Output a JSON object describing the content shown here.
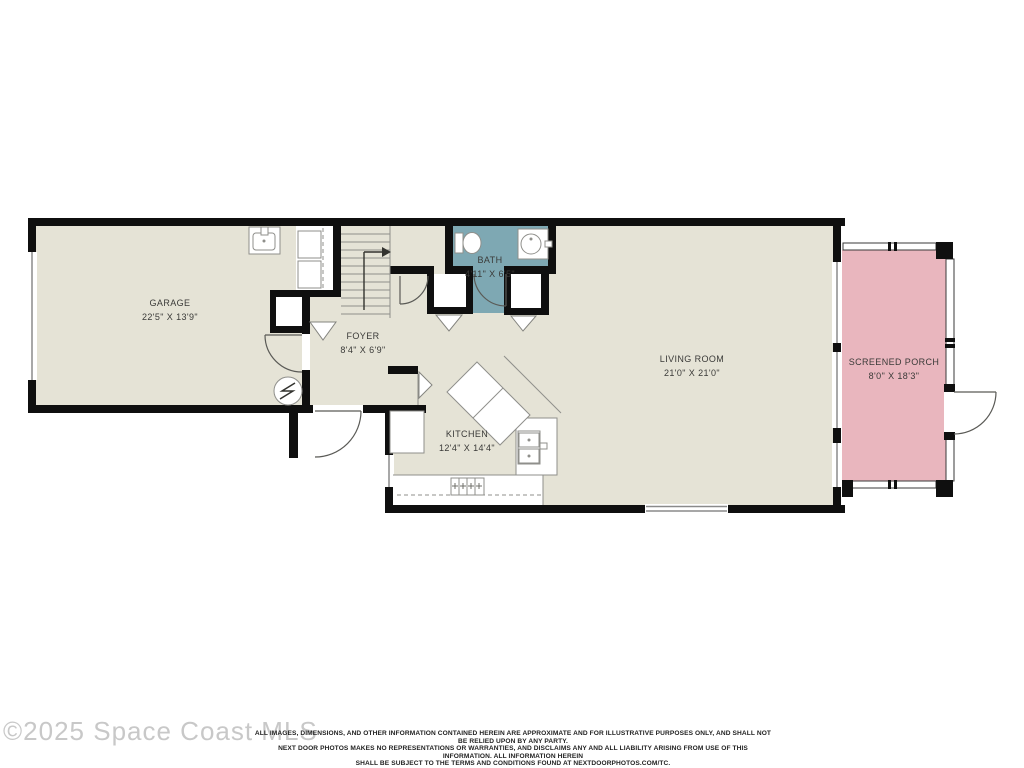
{
  "colors": {
    "background": "#ffffff",
    "floor": "#e5e3d6",
    "wall": "#0f0f0f",
    "bath": "#7ea8b3",
    "porch": "#e9b6be",
    "outline": "#8f8f8b",
    "label_text": "#3a3a38",
    "watermark": "#c8c8c8",
    "disclaimer": "#222222"
  },
  "rooms": {
    "garage": {
      "label": "GARAGE",
      "dims": "22'5\" X 13'9\""
    },
    "foyer": {
      "label": "FOYER",
      "dims": "8'4\" X 6'9\""
    },
    "bath": {
      "label": "BATH",
      "dims": "4'11\" X 6'5\""
    },
    "kitchen": {
      "label": "KITCHEN",
      "dims": "12'4\" X 14'4\""
    },
    "living_room": {
      "label": "LIVING ROOM",
      "dims": "21'0\" X 21'0\""
    },
    "screened_porch": {
      "label": "SCREENED PORCH",
      "dims": "8'0\" X 18'3\""
    }
  },
  "fixtures": [
    "utility-sink",
    "washer-dryer",
    "under-stair-closet",
    "stairs-up-arrow",
    "electrical-panel",
    "garage-entry-door",
    "front-door",
    "hall-door",
    "toilet",
    "bathroom-sink",
    "hall-closets",
    "pantry",
    "refrigerator",
    "island-counter",
    "oven",
    "range",
    "kitchen-counter",
    "windows",
    "sliding-window",
    "screen-walls",
    "porch-door"
  ],
  "footer": {
    "watermark": "©2025 Space Coast MLS",
    "disclaimer_line1": "ALL IMAGES, DIMENSIONS, AND OTHER INFORMATION CONTAINED HEREIN ARE APPROXIMATE AND FOR ILLUSTRATIVE PURPOSES ONLY, AND SHALL NOT BE RELIED UPON BY ANY PARTY.",
    "disclaimer_line2": "NEXT DOOR PHOTOS MAKES NO REPRESENTATIONS OR WARRANTIES, AND DISCLAIMS ANY AND ALL LIABILITY ARISING FROM USE OF THIS INFORMATION. ALL INFORMATION HEREIN",
    "disclaimer_line3": "SHALL BE SUBJECT TO THE TERMS AND CONDITIONS FOUND AT NEXTDOORPHOTOS.COM/TC."
  }
}
